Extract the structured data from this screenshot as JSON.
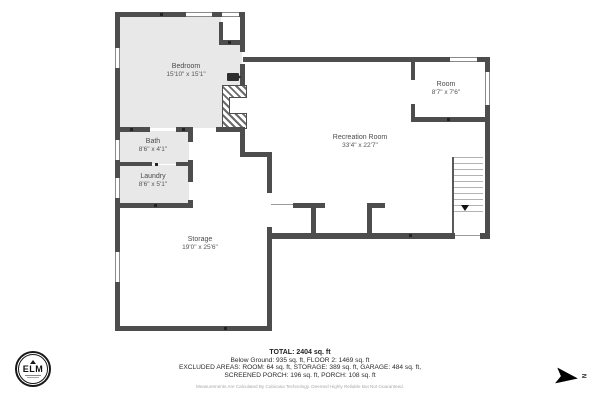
{
  "plan": {
    "rooms": [
      {
        "name": "Bedroom",
        "dims": "15'10\" x 15'1\""
      },
      {
        "name": "Bath",
        "dims": "8'6\" x 4'1\""
      },
      {
        "name": "Laundry",
        "dims": "8'6\" x 5'1\""
      },
      {
        "name": "Storage",
        "dims": "19'0\" x 25'6\""
      },
      {
        "name": "Recreation Room",
        "dims": "33'4\" x 22'7\""
      },
      {
        "name": "Room",
        "dims": "8'7\" x 7'6\""
      }
    ]
  },
  "summary": {
    "total": "TOTAL: 2404 sq. ft",
    "line2": "Below Ground: 935 sq. ft, FLOOR 2: 1469 sq. ft",
    "line3": "EXCLUDED AREAS: ROOM: 64 sq. ft, STORAGE: 389 sq. ft, GARAGE: 484 sq. ft,",
    "line4": "SCREENED PORCH: 196 sq. ft, PORCH: 108 sq. ft",
    "disclaimer": "Measurements Are Calculated By Cubicasa Technology. Deemed Highly Reliable But Not Guaranteed."
  },
  "logo": {
    "text": "ELM"
  },
  "compass": {
    "label": "N"
  },
  "colors": {
    "wall": "#4d4d4d",
    "room_gray": "#e8e8e8",
    "background": "#ffffff"
  }
}
